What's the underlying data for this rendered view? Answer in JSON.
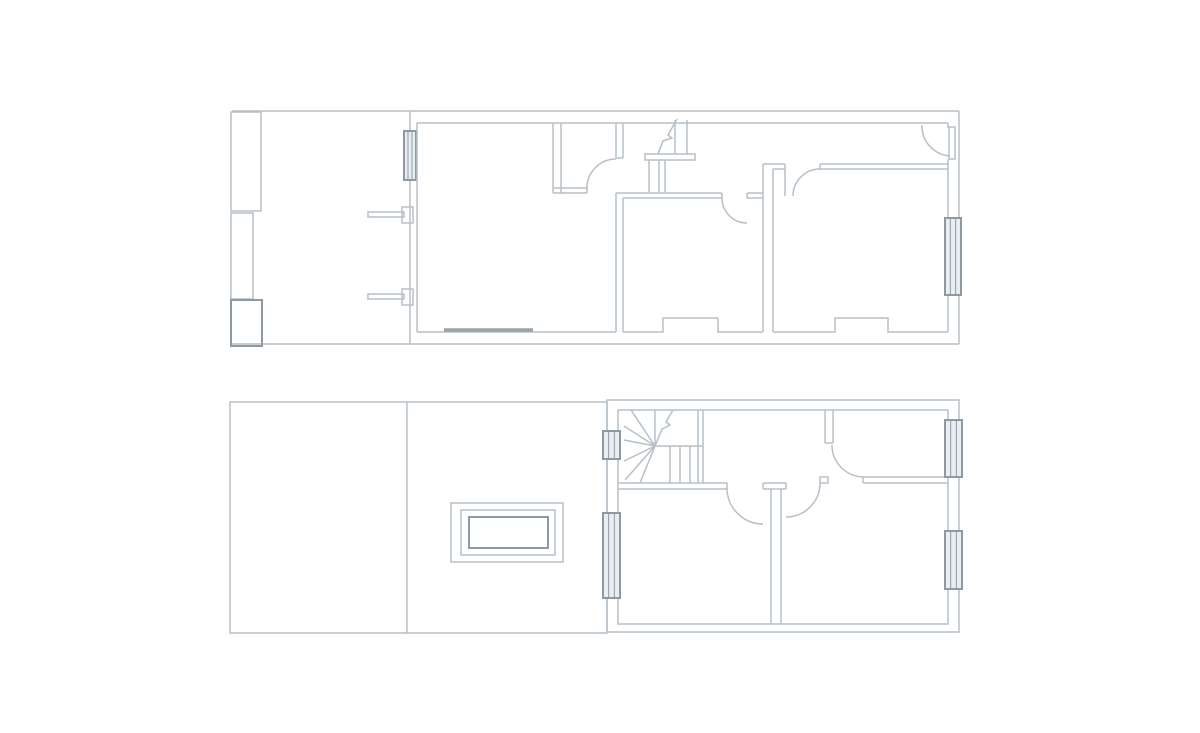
{
  "canvas": {
    "width": 1200,
    "height": 733,
    "background": "#ffffff"
  },
  "colors": {
    "line_light": "#b5c0c9",
    "line_dark": "#8d99a3",
    "sill": "#99a2aa",
    "window_fill": "#e9eef1"
  },
  "stroke_widths": {
    "light": 1.5,
    "dark": 2,
    "sill": 3.5,
    "window_inner": 1
  },
  "plans": [
    {
      "name": "upper-floor-plan",
      "elements": [
        {
          "t": "line",
          "p": [
            232,
            111,
            959,
            111
          ],
          "n": "boundary-top"
        },
        {
          "t": "line",
          "p": [
            959,
            111,
            959,
            344
          ],
          "n": "wall-right-outer"
        },
        {
          "t": "line",
          "p": [
            232,
            344,
            959,
            344
          ],
          "n": "boundary-bottom"
        },
        {
          "t": "rect",
          "p": [
            231,
            112,
            30,
            99
          ],
          "n": "garden-store"
        },
        {
          "t": "rect",
          "p": [
            231,
            213,
            22,
            86
          ],
          "n": "garden-store"
        },
        {
          "t": "rect",
          "p": [
            231,
            300,
            31,
            46
          ],
          "k": "dark",
          "n": "garden-store"
        },
        {
          "t": "line",
          "p": [
            410,
            111,
            410,
            344
          ],
          "n": "side-wall"
        },
        {
          "t": "win",
          "p": [
            404,
            131,
            12,
            49
          ],
          "n": "window"
        },
        {
          "t": "rect",
          "p": [
            368,
            212,
            36,
            5
          ],
          "n": "fence-bar"
        },
        {
          "t": "rect",
          "p": [
            402,
            207,
            11,
            16
          ],
          "n": "fence-pier"
        },
        {
          "t": "rect",
          "p": [
            368,
            294,
            36,
            5
          ],
          "n": "fence-bar"
        },
        {
          "t": "rect",
          "p": [
            402,
            289,
            11,
            16
          ],
          "n": "fence-pier"
        },
        {
          "t": "line",
          "p": [
            417,
            123,
            948,
            123
          ],
          "n": "wall-top-inner"
        },
        {
          "t": "line",
          "p": [
            948,
            123,
            948,
            128
          ],
          "n": "wall-jog"
        },
        {
          "t": "line",
          "p": [
            417,
            123,
            417,
            332
          ],
          "n": "wall-left-inner"
        },
        {
          "t": "line",
          "p": [
            417,
            332,
            616,
            332
          ],
          "n": "front-room-bottom"
        },
        {
          "t": "line",
          "p": [
            444,
            330,
            533,
            330
          ],
          "k": "sill",
          "n": "window-sill"
        },
        {
          "t": "line",
          "p": [
            616,
            193,
            616,
            332
          ],
          "n": "room-divider"
        },
        {
          "t": "line",
          "p": [
            623,
            198,
            623,
            332
          ],
          "n": "room-divider"
        },
        {
          "t": "poly",
          "p": "623,332 663,332 663,318 718,318 718,332 763,332",
          "n": "chimney-breast"
        },
        {
          "t": "poly",
          "p": "773,332 835,332 835,318 888,318 888,332 948,332",
          "n": "chimney-breast"
        },
        {
          "t": "line",
          "p": [
            948,
            159,
            948,
            332
          ],
          "n": "wall-right-inner"
        },
        {
          "t": "win",
          "p": [
            945,
            218,
            16,
            77
          ],
          "n": "window"
        },
        {
          "t": "line",
          "p": [
            553,
            123,
            553,
            193
          ],
          "n": "closet-wall"
        },
        {
          "t": "line",
          "p": [
            561,
            123,
            561,
            193
          ],
          "n": "closet-wall"
        },
        {
          "t": "line",
          "p": [
            553,
            188,
            587,
            188
          ],
          "n": "closet-wall"
        },
        {
          "t": "line",
          "p": [
            553,
            193,
            587,
            193
          ],
          "n": "closet-wall"
        },
        {
          "t": "line",
          "p": [
            587,
            188,
            587,
            193
          ],
          "n": "door-jamb"
        },
        {
          "t": "line",
          "p": [
            616,
            123,
            616,
            158
          ],
          "n": "closet-wall"
        },
        {
          "t": "line",
          "p": [
            623,
            123,
            623,
            158
          ],
          "n": "closet-wall"
        },
        {
          "t": "line",
          "p": [
            616,
            158,
            623,
            158
          ],
          "n": "door-jamb"
        },
        {
          "t": "path",
          "d": "M587,188 A29,29 0 0 1 616,159",
          "n": "door-arc"
        },
        {
          "t": "line",
          "p": [
            675,
            120,
            675,
            154
          ],
          "n": "stair-tread"
        },
        {
          "t": "line",
          "p": [
            687,
            120,
            687,
            154
          ],
          "n": "stair-tread"
        },
        {
          "t": "poly",
          "p": "677,119 668,135 672,138 663,141 658,154",
          "n": "stair-break-line"
        },
        {
          "t": "rect",
          "p": [
            645,
            154,
            50,
            6
          ],
          "n": "stair-landing"
        },
        {
          "t": "line",
          "p": [
            649,
            160,
            649,
            192
          ],
          "n": "stair-tread"
        },
        {
          "t": "line",
          "p": [
            659,
            160,
            659,
            192
          ],
          "n": "stair-tread"
        },
        {
          "t": "line",
          "p": [
            665,
            160,
            665,
            192
          ],
          "n": "stair-tread"
        },
        {
          "t": "line",
          "p": [
            616,
            193,
            722,
            193
          ],
          "n": "hall-wall"
        },
        {
          "t": "line",
          "p": [
            623,
            198,
            722,
            198
          ],
          "n": "hall-wall"
        },
        {
          "t": "line",
          "p": [
            722,
            193,
            722,
            198
          ],
          "n": "door-jamb"
        },
        {
          "t": "path",
          "d": "M722,198 A25,25 0 0 0 747,223",
          "n": "door-arc"
        },
        {
          "t": "line",
          "p": [
            747,
            193,
            763,
            193
          ],
          "n": "hall-wall"
        },
        {
          "t": "line",
          "p": [
            747,
            198,
            763,
            198
          ],
          "n": "hall-wall"
        },
        {
          "t": "line",
          "p": [
            747,
            193,
            747,
            198
          ],
          "n": "door-jamb"
        },
        {
          "t": "line",
          "p": [
            763,
            164,
            763,
            332
          ],
          "n": "room-divider"
        },
        {
          "t": "line",
          "p": [
            773,
            169,
            773,
            332
          ],
          "n": "room-divider"
        },
        {
          "t": "line",
          "p": [
            763,
            164,
            785,
            164
          ],
          "n": "hall-wall"
        },
        {
          "t": "line",
          "p": [
            773,
            169,
            785,
            169
          ],
          "n": "hall-wall"
        },
        {
          "t": "line",
          "p": [
            785,
            164,
            785,
            196
          ],
          "n": "door-jamb"
        },
        {
          "t": "path",
          "d": "M793,196 A27,27 0 0 1 820,169",
          "n": "door-arc"
        },
        {
          "t": "line",
          "p": [
            820,
            164,
            948,
            164
          ],
          "n": "hall-wall"
        },
        {
          "t": "line",
          "p": [
            820,
            169,
            948,
            169
          ],
          "n": "hall-wall"
        },
        {
          "t": "line",
          "p": [
            820,
            164,
            820,
            169
          ],
          "n": "door-jamb"
        },
        {
          "t": "path",
          "d": "M922,125 A30,30 0 0 0 950,156",
          "n": "door-arc"
        },
        {
          "t": "rect",
          "p": [
            949,
            127,
            6,
            32
          ],
          "n": "door-leaf"
        }
      ]
    },
    {
      "name": "lower-floor-plan",
      "elements": [
        {
          "t": "rect",
          "p": [
            230,
            402,
            377,
            231
          ],
          "n": "roof-outline"
        },
        {
          "t": "line",
          "p": [
            407,
            402,
            407,
            633
          ],
          "n": "roof-divider"
        },
        {
          "t": "rect",
          "p": [
            451,
            503,
            112,
            59
          ],
          "n": "skylight"
        },
        {
          "t": "rect",
          "p": [
            461,
            510,
            94,
            45
          ],
          "n": "skylight"
        },
        {
          "t": "rect",
          "p": [
            469,
            517,
            79,
            31
          ],
          "k": "dark",
          "n": "skylight"
        },
        {
          "t": "rect",
          "p": [
            607,
            400,
            352,
            232
          ],
          "n": "wall-outer"
        },
        {
          "t": "rect",
          "p": [
            618,
            410,
            330,
            214
          ],
          "n": "wall-inner"
        },
        {
          "t": "line",
          "p": [
            698,
            410,
            698,
            483
          ],
          "n": "stair-wall"
        },
        {
          "t": "line",
          "p": [
            703,
            410,
            703,
            483
          ],
          "n": "stair-wall"
        },
        {
          "t": "line",
          "p": [
            618,
            483,
            727,
            483
          ],
          "n": "landing-wall"
        },
        {
          "t": "line",
          "p": [
            618,
            489,
            727,
            489
          ],
          "n": "landing-wall"
        },
        {
          "t": "line",
          "p": [
            727,
            483,
            727,
            489
          ],
          "n": "door-jamb"
        },
        {
          "t": "line",
          "p": [
            655,
            446,
            624,
            426
          ],
          "n": "stair-winder"
        },
        {
          "t": "line",
          "p": [
            655,
            446,
            624,
            440
          ],
          "n": "stair-winder"
        },
        {
          "t": "line",
          "p": [
            655,
            446,
            624,
            461
          ],
          "n": "stair-winder"
        },
        {
          "t": "line",
          "p": [
            655,
            446,
            625,
            480
          ],
          "n": "stair-winder"
        },
        {
          "t": "line",
          "p": [
            655,
            446,
            640,
            483
          ],
          "n": "stair-winder"
        },
        {
          "t": "line",
          "p": [
            655,
            446,
            631,
            410
          ],
          "n": "stair-winder"
        },
        {
          "t": "line",
          "p": [
            655,
            446,
            655,
            410
          ],
          "n": "stair-winder"
        },
        {
          "t": "poly",
          "p": "673,410 666,422 670,425 662,429 655,446",
          "n": "stair-break-line"
        },
        {
          "t": "line",
          "p": [
            655,
            446,
            703,
            446
          ],
          "n": "stair-edge"
        },
        {
          "t": "line",
          "p": [
            670,
            446,
            670,
            483
          ],
          "n": "stair-tread"
        },
        {
          "t": "line",
          "p": [
            680,
            446,
            680,
            483
          ],
          "n": "stair-tread"
        },
        {
          "t": "line",
          "p": [
            690,
            446,
            690,
            483
          ],
          "n": "stair-tread"
        },
        {
          "t": "line",
          "p": [
            763,
            483,
            786,
            483
          ],
          "n": "door-stub"
        },
        {
          "t": "line",
          "p": [
            763,
            489,
            786,
            489
          ],
          "n": "door-stub"
        },
        {
          "t": "line",
          "p": [
            763,
            483,
            763,
            489
          ],
          "n": "door-jamb"
        },
        {
          "t": "line",
          "p": [
            786,
            483,
            786,
            489
          ],
          "n": "door-jamb"
        },
        {
          "t": "path",
          "d": "M727,488 A36,36 0 0 0 763,524",
          "n": "door-arc"
        },
        {
          "t": "path",
          "d": "M820,483 A34,34 0 0 1 786,517",
          "n": "door-arc"
        },
        {
          "t": "line",
          "p": [
            771,
            489,
            771,
            624
          ],
          "n": "bedroom-divider"
        },
        {
          "t": "line",
          "p": [
            781,
            489,
            781,
            624
          ],
          "n": "bedroom-divider"
        },
        {
          "t": "line",
          "p": [
            825,
            410,
            825,
            443
          ],
          "n": "landing-wall"
        },
        {
          "t": "line",
          "p": [
            833,
            410,
            833,
            443
          ],
          "n": "landing-wall"
        },
        {
          "t": "line",
          "p": [
            825,
            443,
            833,
            443
          ],
          "n": "door-jamb"
        },
        {
          "t": "path",
          "d": "M832,445 A32,32 0 0 0 863,477",
          "n": "door-arc"
        },
        {
          "t": "line",
          "p": [
            863,
            477,
            948,
            477
          ],
          "n": "room-wall"
        },
        {
          "t": "line",
          "p": [
            863,
            483,
            948,
            483
          ],
          "n": "room-wall"
        },
        {
          "t": "line",
          "p": [
            863,
            477,
            863,
            483
          ],
          "n": "door-jamb"
        },
        {
          "t": "rect",
          "p": [
            820,
            477,
            8,
            6
          ],
          "n": "door-jamb"
        },
        {
          "t": "win",
          "p": [
            603,
            431,
            17,
            28
          ],
          "n": "window"
        },
        {
          "t": "win",
          "p": [
            603,
            513,
            17,
            85
          ],
          "n": "window"
        },
        {
          "t": "win",
          "p": [
            945,
            420,
            17,
            57
          ],
          "n": "window"
        },
        {
          "t": "win",
          "p": [
            945,
            531,
            17,
            58
          ],
          "n": "window"
        }
      ]
    }
  ]
}
